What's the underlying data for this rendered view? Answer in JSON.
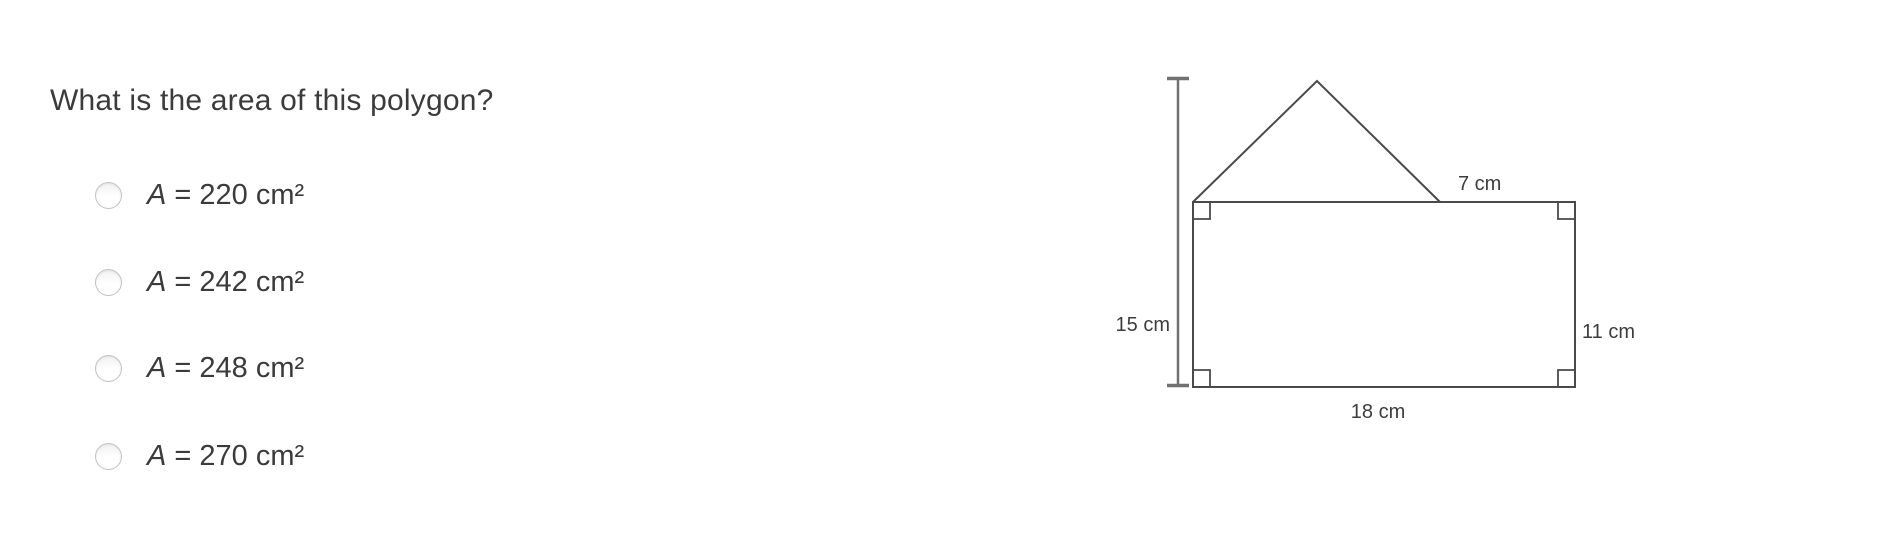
{
  "question": {
    "text": "What is the area of this polygon?"
  },
  "options": [
    {
      "var": "A",
      "rest": " = 220 cm²"
    },
    {
      "var": "A",
      "rest": " = 242 cm²"
    },
    {
      "var": "A",
      "rest": " = 248 cm²"
    },
    {
      "var": "A",
      "rest": " = 270 cm²"
    }
  ],
  "figure": {
    "description": "Composite polygon: 18 cm × 11 cm rectangle with a triangle on top; total height 15 cm; triangle slant side 7 cm",
    "labels": {
      "total_height": "15 cm",
      "slant_side": "7 cm",
      "rect_height": "11 cm",
      "rect_width": "18 cm"
    },
    "values": {
      "total_height_cm": 15,
      "slant_side_cm": 7,
      "rect_height_cm": 11,
      "rect_width_cm": 18
    }
  },
  "colors": {
    "background": "#ffffff",
    "text": "#3b3b3b",
    "shape_stroke": "#4a4a4a",
    "measure_stroke": "#707070",
    "radio_border": "#c2c2c2"
  }
}
